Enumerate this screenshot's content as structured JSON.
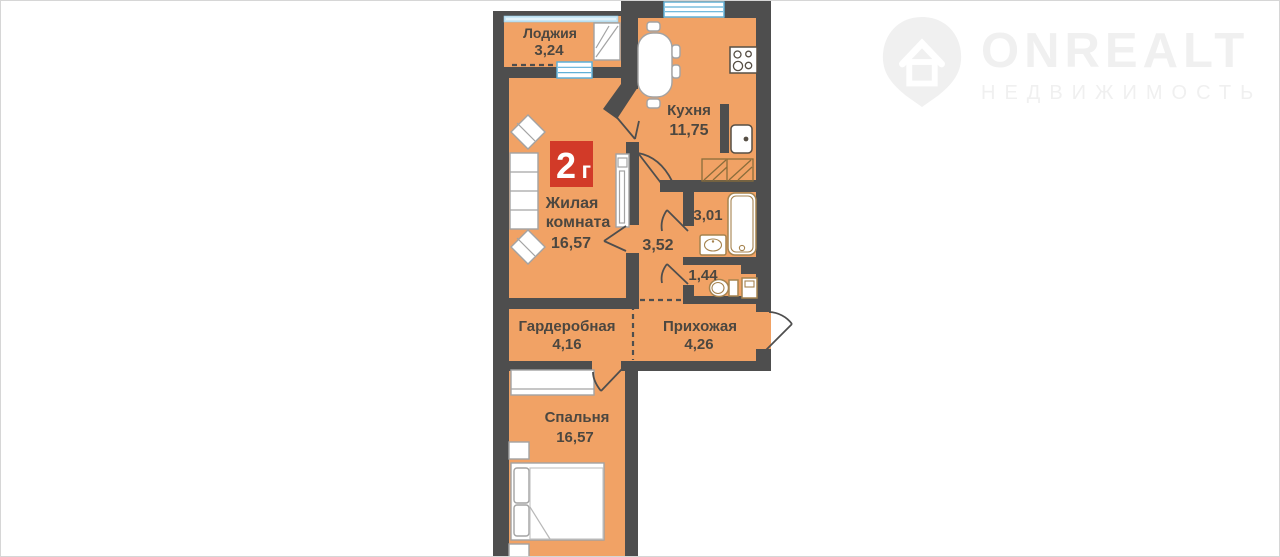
{
  "watermark": {
    "title": "ONREALT",
    "subtitle": "НЕДВИЖИМОСТЬ"
  },
  "badge": {
    "label": "2г",
    "char_main": "2",
    "char_suffix": "г"
  },
  "rooms": {
    "loggia": {
      "name": "Лоджия",
      "area": "3,24"
    },
    "kitchen": {
      "name": "Кухня",
      "area": "11,75"
    },
    "living_room": {
      "name_line1": "Жилая",
      "name_line2": "комната",
      "area": "16,57"
    },
    "corridor": {
      "area": "3,52"
    },
    "bathroom": {
      "area": "3,01"
    },
    "toilet": {
      "area": "1,44"
    },
    "wardrobe_room": {
      "name": "Гардеробная",
      "area": "4,16"
    },
    "hallway": {
      "name": "Прихожая",
      "area": "4,26"
    },
    "bedroom": {
      "name": "Спальня",
      "area": "16,57"
    }
  },
  "colors": {
    "floor": "#f1a265",
    "wall": "#4e4e4e",
    "badge_red": "#d23a28",
    "window_blue": "#c9e7f5",
    "watermark_gray": "#f0f0f0"
  }
}
